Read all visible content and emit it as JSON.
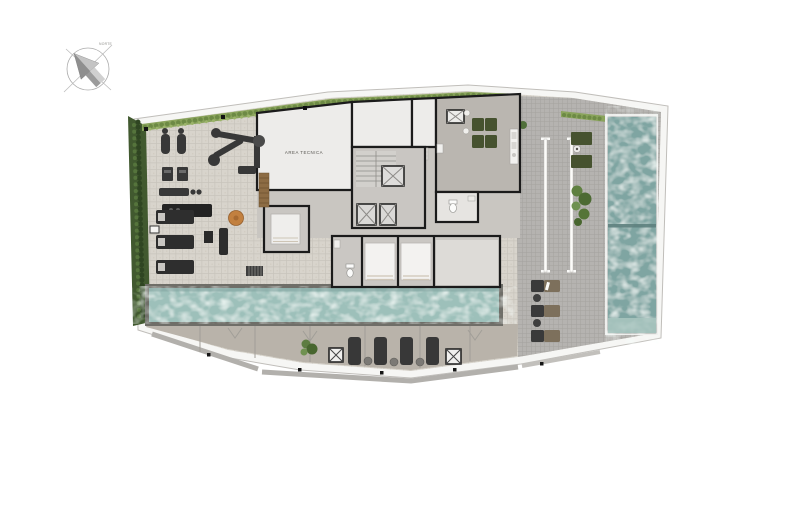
{
  "compass": {
    "label": "NORTE",
    "icon": "north-arrow-3d"
  },
  "plan": {
    "labels": {
      "area_tecnica": "AREA TECNICA"
    },
    "symbols": {
      "elevator": "x-cross-box",
      "stairs": "parallel-treads",
      "expansion_joint": "zigzag-mark",
      "service_table": "x-cross-table"
    },
    "colors": {
      "wall": "#1b1b1b",
      "parapet": "#f6f6f4",
      "outline": "#c0beba",
      "deck_light": "#d8d4cc",
      "deck_light_line": "#c8c4bb",
      "deck_gray": "#b5b3b0",
      "deck_gray_line": "#a5a39f",
      "deck_warm": "#b9b3aa",
      "room_white": "#edecea",
      "room_gray": "#c9c6c2",
      "water_light": "#9dc0ba",
      "water_dark": "#7fa5a2",
      "pool_coping": "#6f6e68",
      "hedge_dark": "#41592f",
      "hedge_light": "#8aa45c",
      "equipment_dark": "#383838",
      "daybed_green": "#46522f",
      "wood": "#8d6c44",
      "accent_orange": "#c2803f"
    }
  }
}
